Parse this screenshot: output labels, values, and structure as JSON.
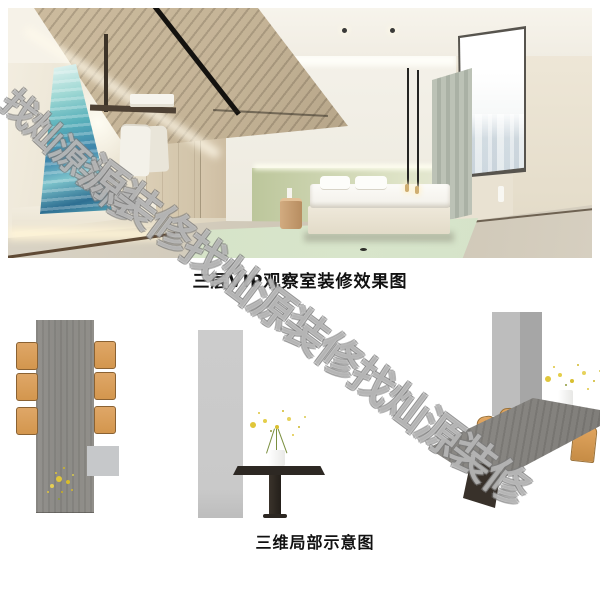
{
  "render": {
    "caption": "三层VIP观察室装修效果图"
  },
  "schematic": {
    "caption": "三维局部示意图"
  },
  "watermark": {
    "phrase": "装修找灿源",
    "lines": [
      {
        "text": "找灿源装修",
        "x": 26,
        "y": 76,
        "size": 36,
        "rotation": 43
      },
      {
        "text": "源装修找灿源装修找灿源装修",
        "x": 108,
        "y": 138,
        "size": 44,
        "rotation": 37
      }
    ]
  },
  "colors": {
    "caption_text": "#111111",
    "watermark_fill": "rgba(255,255,255,0.42)",
    "watermark_stroke": "rgba(122,122,122,0.55)",
    "chair_orange": "#dfa768",
    "table_gray": "#8b8a86",
    "panel_gray": "#c9c9c9",
    "headboard_green": "#bcc69b",
    "rug_green": "#d8e5cb",
    "ceiling_wood": "#c4b396",
    "art_teal": "#58b0ba",
    "dark_table": "#2d2823"
  }
}
